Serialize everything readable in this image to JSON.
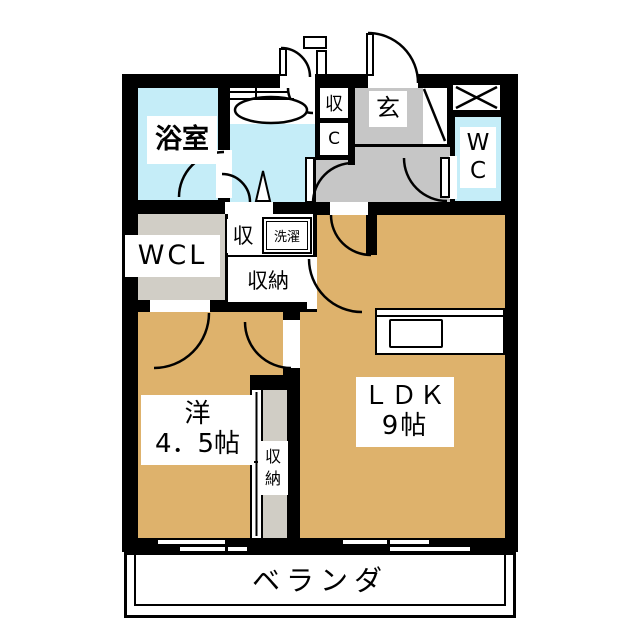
{
  "plan": {
    "type": "apartment-floorplan",
    "rooms": {
      "bathroom": {
        "label": "浴室"
      },
      "wcl": {
        "label": "WCL"
      },
      "strip_storage": {
        "label": "収"
      },
      "strip_closet": {
        "label": "C"
      },
      "nook_storage": {
        "label": "収"
      },
      "laundry": {
        "label": "洗濯"
      },
      "mid_storage": {
        "label": "収納"
      },
      "genkan": {
        "label": "玄"
      },
      "wc": {
        "line1": "W",
        "line2": "C"
      },
      "ldk": {
        "name": "ＬＤＫ",
        "size": "9帖"
      },
      "western": {
        "name": "洋",
        "size": "4．5帖"
      },
      "closet_vertical": {
        "line1": "収",
        "line2": "納"
      },
      "veranda": {
        "label": "ベランダ"
      }
    },
    "colors": {
      "wall": "#000000",
      "room_tan": "#deb26c",
      "water_blue": "#c5edf8",
      "hall_gray": "#c6c6c6",
      "wcl_gray": "#d1cec6",
      "closet_gray": "#d0cdc5",
      "background": "#ffffff"
    }
  }
}
